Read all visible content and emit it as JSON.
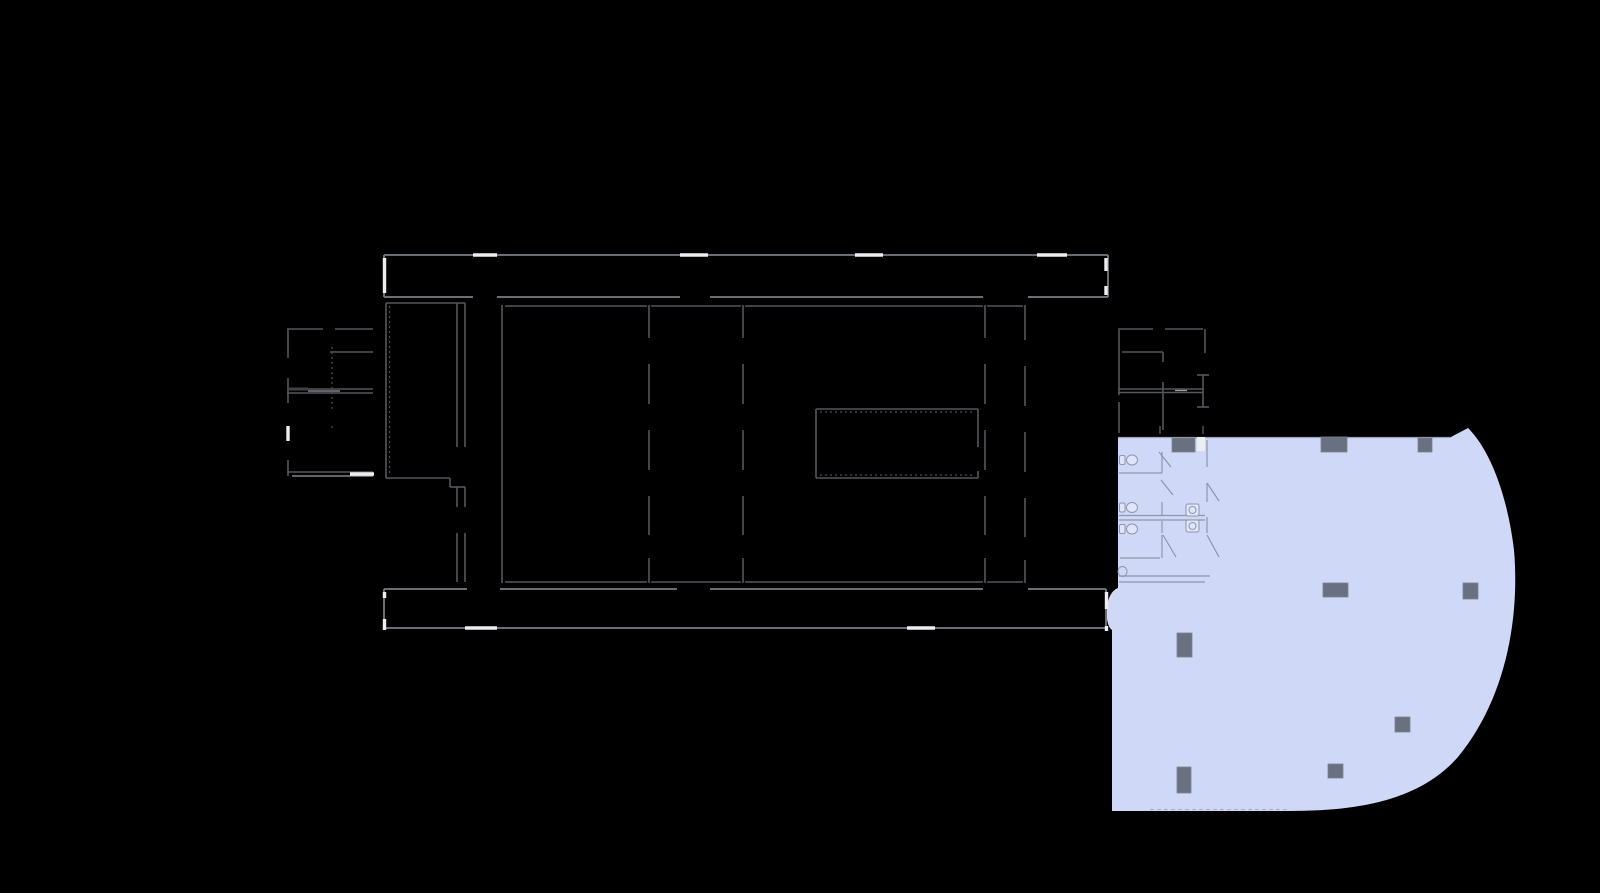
{
  "scene": {
    "type": "building-floor-plan",
    "canvas": {
      "width": 1600,
      "height": 893
    },
    "background": "#000000"
  },
  "colors": {
    "background": "#000000",
    "highlight_fill": "#cfd8f7",
    "column_fill": "#697080",
    "wall_main": "#6b6e72",
    "wall_thin": "#54575b",
    "wall_dark": "#3f4246",
    "wall_light": "#9ca0a4",
    "opening_white": "#eceef0",
    "bath_line": "#8e96ac",
    "fixture_fill": "#dfe5fb",
    "unit_top_edge": "#9aa1b6",
    "unit_bottom_edge": "#aab1c6",
    "tick": "#75787c"
  },
  "styles": {
    "main": {
      "stroke": "#6b6e72",
      "w": 2
    },
    "thin": {
      "stroke": "#54575b",
      "w": 1.6
    },
    "dark": {
      "stroke": "#3f4246",
      "w": 3
    },
    "light": {
      "stroke": "#9ca0a4",
      "w": 1.3
    },
    "dotted": {
      "stroke": "#4e5154",
      "w": 1.2,
      "dash": "2 3"
    },
    "tick": {
      "stroke": "#75787c",
      "w": 1
    },
    "bath": {
      "stroke": "#8e96ac",
      "w": 1.2
    },
    "blueEdge": {
      "stroke": "#9aa1b6",
      "w": 1.2
    },
    "blueBottom": {
      "stroke": "#aab1c6",
      "w": 1,
      "dash": "4 3"
    },
    "white": {
      "stroke": "#eceef0",
      "w": 3.4
    }
  },
  "highlighted_unit": {
    "fill": "#cfd8f7",
    "path": "M 1118,437 H 1451 L 1468,428 C 1492,452 1508,500 1514,550 C 1520,620 1505,700 1458,757 C 1420,800 1360,811 1290,811 H 1112 V 630 C 1104,625 1104,593 1118,588 Z",
    "top_edge": [
      1118,
      437.5,
      1451,
      437.5
    ],
    "bottom_edge": [
      1150,
      809.5,
      1289,
      809.5
    ],
    "white_wall_rect": [
      1197,
      437,
      8,
      14
    ],
    "columns": [
      [
        1172,
        438,
        23,
        14
      ],
      [
        1321,
        437,
        26,
        15
      ],
      [
        1418,
        438,
        14,
        14
      ],
      [
        1323,
        583,
        25,
        14
      ],
      [
        1463,
        583,
        15,
        16
      ],
      [
        1177,
        633,
        15,
        24
      ],
      [
        1395,
        717,
        15,
        15
      ],
      [
        1177,
        767,
        14,
        26
      ],
      [
        1328,
        764,
        15,
        14
      ]
    ]
  },
  "bathroom": {
    "toilets": [
      {
        "cx": 1132,
        "cy": 460
      },
      {
        "cx": 1132,
        "cy": 507.5
      },
      {
        "cx": 1132,
        "cy": 529
      }
    ],
    "toilet_partial": {
      "cx": 1122.5,
      "cy": 571.5,
      "rx": 4.5,
      "ry": 5
    },
    "sinks": [
      {
        "x": 1186,
        "y": 504,
        "w": 13,
        "h": 12
      },
      {
        "x": 1186,
        "y": 520,
        "w": 13,
        "h": 12
      }
    ]
  },
  "linework": {
    "segments": [
      [
        384,
        255,
        473,
        255,
        "main"
      ],
      [
        497,
        255,
        680,
        255,
        "main"
      ],
      [
        708,
        255,
        855,
        255,
        "main"
      ],
      [
        883,
        255,
        1037,
        255,
        "main"
      ],
      [
        1067,
        255,
        1108,
        255,
        "main"
      ],
      [
        384,
        297,
        473,
        297,
        "main"
      ],
      [
        497,
        297,
        680,
        297,
        "main"
      ],
      [
        710,
        297,
        983,
        297,
        "main"
      ],
      [
        1028,
        297,
        1108,
        297,
        "main"
      ],
      [
        384,
        589,
        467,
        589,
        "main"
      ],
      [
        500,
        589,
        677,
        589,
        "main"
      ],
      [
        710,
        589,
        983,
        589,
        "main"
      ],
      [
        1028,
        589,
        1106,
        589,
        "main"
      ],
      [
        384,
        628,
        465,
        628,
        "main"
      ],
      [
        497,
        628,
        907,
        628,
        "main"
      ],
      [
        935,
        628,
        1106,
        628,
        "main"
      ],
      [
        384,
        255,
        384,
        297,
        "main"
      ],
      [
        384,
        589,
        384,
        628,
        "main"
      ],
      [
        1108,
        255,
        1108,
        297,
        "main"
      ],
      [
        1106,
        589,
        1106,
        628,
        "main"
      ],
      [
        502,
        305,
        502,
        583,
        "thin"
      ],
      [
        649,
        305,
        649,
        338,
        "thin"
      ],
      [
        649,
        364,
        649,
        404,
        "thin"
      ],
      [
        649,
        430,
        649,
        470,
        "thin"
      ],
      [
        649,
        496,
        649,
        535,
        "thin"
      ],
      [
        649,
        558,
        649,
        583,
        "thin"
      ],
      [
        743,
        305,
        743,
        338,
        "thin"
      ],
      [
        743,
        364,
        743,
        404,
        "thin"
      ],
      [
        743,
        430,
        743,
        470,
        "thin"
      ],
      [
        743,
        496,
        743,
        535,
        "thin"
      ],
      [
        743,
        558,
        743,
        583,
        "thin"
      ],
      [
        985,
        305,
        985,
        338,
        "thin"
      ],
      [
        985,
        364,
        985,
        404,
        "thin"
      ],
      [
        985,
        430,
        985,
        470,
        "thin"
      ],
      [
        985,
        496,
        985,
        535,
        "thin"
      ],
      [
        985,
        558,
        985,
        583,
        "thin"
      ],
      [
        1025,
        305,
        1025,
        340,
        "thin"
      ],
      [
        1025,
        366,
        1025,
        406,
        "thin"
      ],
      [
        1025,
        432,
        1025,
        472,
        "thin"
      ],
      [
        1025,
        498,
        1025,
        537,
        "thin"
      ],
      [
        1025,
        560,
        1025,
        583,
        "thin"
      ],
      [
        505,
        306,
        647,
        306,
        "thin"
      ],
      [
        651,
        306,
        741,
        306,
        "thin"
      ],
      [
        745,
        306,
        983,
        306,
        "thin"
      ],
      [
        987,
        306,
        1023,
        306,
        "thin"
      ],
      [
        505,
        582,
        647,
        582,
        "thin"
      ],
      [
        651,
        582,
        741,
        582,
        "thin"
      ],
      [
        745,
        582,
        983,
        582,
        "thin"
      ],
      [
        987,
        582,
        1023,
        582,
        "thin"
      ],
      [
        386,
        303,
        465,
        303,
        "thin"
      ],
      [
        386,
        303,
        386,
        478,
        "thin"
      ],
      [
        457,
        303,
        457,
        447,
        "thin"
      ],
      [
        465,
        303,
        465,
        447,
        "thin"
      ],
      [
        457,
        487,
        457,
        507,
        "thin"
      ],
      [
        465,
        487,
        465,
        507,
        "thin"
      ],
      [
        457,
        533,
        457,
        582,
        "thin"
      ],
      [
        465,
        533,
        465,
        582,
        "thin"
      ],
      [
        386,
        478,
        450,
        478,
        "thin"
      ],
      [
        450,
        478,
        450,
        487,
        "thin"
      ],
      [
        450,
        487,
        465,
        487,
        "thin"
      ],
      [
        287,
        329,
        323,
        329,
        "thin"
      ],
      [
        335,
        329,
        373,
        329,
        "thin"
      ],
      [
        288,
        329,
        288,
        358,
        "thin"
      ],
      [
        288,
        378,
        288,
        403,
        "thin"
      ],
      [
        288,
        460,
        288,
        476,
        "thin"
      ],
      [
        330,
        352,
        373,
        352,
        "thin"
      ],
      [
        287,
        389,
        373,
        389,
        "thin"
      ],
      [
        287,
        393,
        373,
        393,
        "thin"
      ],
      [
        287,
        472,
        373,
        472,
        "thin"
      ],
      [
        287,
        389,
        308,
        389,
        "dark"
      ],
      [
        308,
        391,
        340,
        391,
        "light"
      ],
      [
        292,
        476,
        373,
        476,
        "light"
      ],
      [
        816,
        409,
        978,
        409,
        "thin"
      ],
      [
        816,
        478,
        978,
        478,
        "thin"
      ],
      [
        816,
        409,
        816,
        478,
        "thin"
      ],
      [
        978,
        409,
        978,
        447,
        "thin"
      ],
      [
        978,
        471,
        978,
        478,
        "thin"
      ],
      [
        1118,
        329,
        1153,
        329,
        "thin"
      ],
      [
        1165,
        329,
        1203,
        329,
        "thin"
      ],
      [
        1205,
        329,
        1205,
        353,
        "thin"
      ],
      [
        1119,
        330,
        1119,
        395,
        "thin"
      ],
      [
        1119,
        402,
        1119,
        433,
        "thin"
      ],
      [
        1122,
        352,
        1163,
        352,
        "thin"
      ],
      [
        1163,
        352,
        1163,
        362,
        "thin"
      ],
      [
        1163,
        382,
        1163,
        430,
        "thin"
      ],
      [
        1118,
        389,
        1203,
        389,
        "thin"
      ],
      [
        1118,
        392.5,
        1203,
        392.5,
        "thin"
      ],
      [
        1175,
        390.5,
        1187,
        390.5,
        "light"
      ],
      [
        1203,
        375,
        1203,
        407,
        "thin"
      ],
      [
        1197,
        375,
        1209,
        375,
        "thin"
      ],
      [
        1197,
        407,
        1209,
        407,
        "thin"
      ],
      [
        389.5,
        306,
        389.5,
        476,
        "dotted"
      ],
      [
        332,
        347,
        332,
        412,
        "dotted"
      ],
      [
        332,
        426,
        332,
        431,
        "dotted"
      ],
      [
        820,
        412,
        974,
        412,
        "dotted"
      ],
      [
        820,
        475,
        974,
        475,
        "dotted"
      ],
      [
        1160,
        426,
        1160,
        434,
        "tick"
      ],
      [
        1203,
        426,
        1203,
        434,
        "tick"
      ]
    ],
    "unit_edges": [
      [
        1118,
        437.5,
        1451,
        437.5,
        "blueEdge"
      ],
      [
        1150,
        809.5,
        1289,
        809.5,
        "blueBottom"
      ]
    ],
    "bath_segments": [
      [
        1207,
        440,
        1207,
        467,
        "bath"
      ],
      [
        1207,
        483,
        1207,
        502,
        "bath"
      ],
      [
        1207,
        517,
        1207,
        533,
        "bath"
      ],
      [
        1162,
        452,
        1162,
        473,
        "bath"
      ],
      [
        1162,
        502,
        1162,
        515,
        "bath"
      ],
      [
        1162,
        521,
        1162,
        533,
        "bath"
      ],
      [
        1162,
        535,
        1162,
        558,
        "bath"
      ],
      [
        1119,
        473,
        1162,
        473,
        "bath"
      ],
      [
        1119,
        515.5,
        1205,
        515.5,
        "bath"
      ],
      [
        1119,
        520,
        1205,
        520,
        "bath"
      ],
      [
        1120,
        558,
        1160,
        558,
        "bath"
      ],
      [
        1119,
        576,
        1210,
        576,
        "bath"
      ],
      [
        1119,
        582,
        1205,
        582,
        "bath"
      ],
      [
        1159,
        452,
        1171,
        467,
        "bath"
      ],
      [
        1161,
        480,
        1173,
        495,
        "bath"
      ],
      [
        1163,
        535,
        1176,
        557,
        "bath"
      ],
      [
        1207,
        483,
        1219,
        501,
        "bath"
      ],
      [
        1207,
        535,
        1219,
        557,
        "bath"
      ]
    ],
    "white_openings": [
      [
        473,
        255,
        497,
        255,
        "white"
      ],
      [
        680,
        255,
        708,
        255,
        "white"
      ],
      [
        855,
        255,
        883,
        255,
        "white"
      ],
      [
        1037,
        255,
        1067,
        255,
        "white"
      ],
      [
        465,
        628,
        497,
        628,
        "white"
      ],
      [
        907,
        628,
        935,
        628,
        "white"
      ],
      [
        384.5,
        258,
        384.5,
        293,
        "white"
      ],
      [
        384.5,
        592,
        384.5,
        598,
        "white"
      ],
      [
        384.5,
        619,
        384.5,
        630,
        "white"
      ],
      [
        1106,
        258,
        1106,
        271,
        "white"
      ],
      [
        1106,
        286,
        1106,
        295,
        "white"
      ],
      [
        1106.5,
        592,
        1106.5,
        609,
        "white"
      ],
      [
        1106.5,
        626,
        1106.5,
        631,
        "white"
      ],
      [
        288,
        426,
        288,
        441,
        "white"
      ],
      [
        350,
        474,
        374,
        474,
        "white"
      ]
    ]
  }
}
